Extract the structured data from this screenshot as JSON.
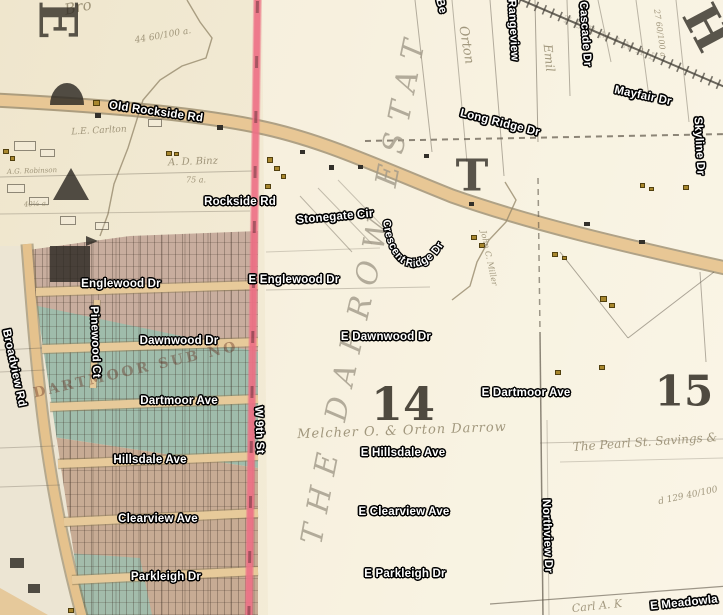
{
  "map": {
    "colors": {
      "parchment": "#f2ead4",
      "parchment_light": "#f7f1e2",
      "road_fill": "#e8c795",
      "road_casing": "#7e6d49",
      "city_boundary_pink": "#ee7186",
      "subdivision_green": "#9fbcab",
      "subdivision_pink": "#c8ad9e",
      "street_label_text": "#ffffff",
      "street_label_halo": "#000000",
      "handwriting_ink": "#8f8468",
      "plat_ink": "#33302a"
    },
    "street_labels": [
      {
        "text": "Old Rockside Rd",
        "x": 156,
        "y": 112,
        "rot": 8
      },
      {
        "text": "Rockside Rd",
        "x": 240,
        "y": 202,
        "rot": 0
      },
      {
        "text": "Stonegate Cir",
        "x": 335,
        "y": 217,
        "rot": -5
      },
      {
        "text": "Long Ridge Dr",
        "x": 500,
        "y": 123,
        "rot": 14
      },
      {
        "text": "Mayfair Dr",
        "x": 643,
        "y": 96,
        "rot": 12
      },
      {
        "text": "Skyline Dr",
        "x": 699,
        "y": 146,
        "rot": 87
      },
      {
        "text": "Rangeview",
        "x": 513,
        "y": 30,
        "rot": 87
      },
      {
        "text": "Cascade Dr",
        "x": 585,
        "y": 34,
        "rot": 86
      },
      {
        "text": "Be",
        "x": 441,
        "y": 6,
        "rot": 75
      },
      {
        "text": "Englewood Dr",
        "x": 121,
        "y": 284,
        "rot": 0
      },
      {
        "text": "E Englewood Dr",
        "x": 294,
        "y": 280,
        "rot": 0
      },
      {
        "text": "Dawnwood Dr",
        "x": 179,
        "y": 341,
        "rot": 0
      },
      {
        "text": "E Dawnwood Dr",
        "x": 386,
        "y": 337,
        "rot": 0
      },
      {
        "text": "Dartmoor Ave",
        "x": 179,
        "y": 401,
        "rot": 0
      },
      {
        "text": "E Dartmoor Ave",
        "x": 526,
        "y": 393,
        "rot": 0
      },
      {
        "text": "Hillsdale Ave",
        "x": 150,
        "y": 460,
        "rot": 0
      },
      {
        "text": "E Hillsdale Ave",
        "x": 403,
        "y": 453,
        "rot": 0
      },
      {
        "text": "Clearview Ave",
        "x": 158,
        "y": 519,
        "rot": 0
      },
      {
        "text": "E Clearview Ave",
        "x": 404,
        "y": 512,
        "rot": 0
      },
      {
        "text": "Parkleigh Dr",
        "x": 166,
        "y": 577,
        "rot": 0
      },
      {
        "text": "E Parkleigh Dr",
        "x": 405,
        "y": 574,
        "rot": 0
      },
      {
        "text": "W 9th St",
        "x": 259,
        "y": 430,
        "rot": 88
      },
      {
        "text": "Northview Dr",
        "x": 547,
        "y": 536,
        "rot": 88
      },
      {
        "text": "Pinewood Ct",
        "x": 95,
        "y": 342,
        "rot": 88
      },
      {
        "text": "Broadview Rd",
        "x": 14,
        "y": 368,
        "rot": 78
      },
      {
        "text": "E Meadowla",
        "x": 684,
        "y": 603,
        "rot": -6
      }
    ],
    "curved_street_label": {
      "text": "Crescent Ridge Dr"
    },
    "estate_label": {
      "text": "THE DARROW ESTATE"
    },
    "section_numbers": [
      {
        "text": "14",
        "x": 403,
        "y": 404,
        "size": 46
      },
      {
        "text": "15",
        "x": 684,
        "y": 391,
        "size": 42
      }
    ],
    "plat_letters": [
      {
        "text": "E",
        "x": 57,
        "y": 20,
        "rot": 90,
        "size": 52
      },
      {
        "text": "T",
        "x": 472,
        "y": 176,
        "rot": 0,
        "size": 44
      },
      {
        "text": "H",
        "x": 706,
        "y": 28,
        "rot": 62,
        "size": 48
      }
    ],
    "annotations": [
      {
        "t": "Bro",
        "x": 78,
        "y": 7,
        "rot": -12,
        "s": 15
      },
      {
        "t": "44 60/100 a.",
        "x": 163,
        "y": 36,
        "rot": -10,
        "s": 9
      },
      {
        "t": "L.E. Carlton",
        "x": 99,
        "y": 131,
        "rot": -3,
        "s": 9
      },
      {
        "t": "A. D. Binz",
        "x": 193,
        "y": 162,
        "rot": -2,
        "s": 10
      },
      {
        "t": "75 a.",
        "x": 196,
        "y": 180,
        "rot": 0,
        "s": 8
      },
      {
        "t": "A.G. Robinson",
        "x": 32,
        "y": 171,
        "rot": -2,
        "s": 7
      },
      {
        "t": "40½ a.",
        "x": 36,
        "y": 204,
        "rot": -3,
        "s": 7
      },
      {
        "t": "Orton",
        "x": 466,
        "y": 45,
        "rot": 80,
        "s": 13
      },
      {
        "t": "Emil",
        "x": 549,
        "y": 58,
        "rot": 84,
        "s": 12
      },
      {
        "t": "John C. Miller",
        "x": 489,
        "y": 258,
        "rot": 78,
        "s": 8
      },
      {
        "t": "Melcher O. & Orton Darrow",
        "x": 402,
        "y": 431,
        "rot": -2,
        "s": 13,
        "ls": 1
      },
      {
        "t": "The Pearl St. Savings &",
        "x": 645,
        "y": 442,
        "rot": -4,
        "s": 12
      },
      {
        "t": "d 129 40/100",
        "x": 688,
        "y": 496,
        "rot": -12,
        "s": 9
      },
      {
        "t": "Carl A. K",
        "x": 597,
        "y": 606,
        "rot": -6,
        "s": 11
      },
      {
        "t": "27 60/100 a",
        "x": 660,
        "y": 33,
        "rot": 82,
        "s": 8
      },
      {
        "t": "TERMINAL",
        "x": 612,
        "y": 40,
        "rot": 23,
        "s": 10,
        "ls": 6,
        "c": "rgba(95,85,70,0.38)"
      },
      {
        "t": "DARTMOOR SUB NO",
        "x": 136,
        "y": 370,
        "rot": -13,
        "s": 14,
        "ls": 3,
        "c": "rgba(99,45,30,0.5)",
        "plain": true
      }
    ],
    "buildings": {
      "gold": [
        [
          93,
          100,
          7,
          6
        ],
        [
          3,
          149,
          6,
          5
        ],
        [
          10,
          156,
          5,
          5
        ],
        [
          166,
          151,
          6,
          5
        ],
        [
          174,
          152,
          5,
          4
        ],
        [
          267,
          157,
          6,
          6
        ],
        [
          274,
          166,
          6,
          5
        ],
        [
          281,
          174,
          5,
          5
        ],
        [
          265,
          184,
          6,
          5
        ],
        [
          471,
          235,
          6,
          5
        ],
        [
          479,
          243,
          6,
          5
        ],
        [
          552,
          252,
          6,
          5
        ],
        [
          562,
          256,
          5,
          4
        ],
        [
          600,
          296,
          7,
          6
        ],
        [
          609,
          303,
          6,
          5
        ],
        [
          640,
          183,
          5,
          5
        ],
        [
          649,
          187,
          5,
          4
        ],
        [
          683,
          185,
          6,
          5
        ],
        [
          555,
          370,
          6,
          5
        ],
        [
          599,
          365,
          6,
          5
        ],
        [
          68,
          608,
          6,
          5
        ]
      ],
      "dark": [
        [
          95,
          113,
          6,
          5
        ],
        [
          217,
          125,
          6,
          5
        ],
        [
          329,
          165,
          5,
          5
        ],
        [
          469,
          202,
          5,
          4
        ],
        [
          584,
          222,
          6,
          4
        ],
        [
          639,
          240,
          6,
          4
        ],
        [
          424,
          154,
          5,
          4
        ],
        [
          300,
          150,
          5,
          4
        ],
        [
          358,
          165,
          5,
          4
        ]
      ],
      "outline": [
        [
          14,
          141,
          22,
          10
        ],
        [
          40,
          149,
          15,
          8
        ],
        [
          7,
          184,
          18,
          9
        ],
        [
          29,
          197,
          20,
          8
        ],
        [
          148,
          119,
          14,
          8
        ],
        [
          60,
          216,
          16,
          9
        ],
        [
          95,
          222,
          14,
          8
        ]
      ]
    },
    "dark_features": [
      {
        "type": "arch",
        "x": 50,
        "y": 83,
        "w": 34,
        "h": 22
      },
      {
        "type": "triangle",
        "x": 53,
        "y": 168,
        "w": 36,
        "h": 32
      },
      {
        "type": "block",
        "x": 50,
        "y": 246,
        "w": 40,
        "h": 36
      },
      {
        "type": "flag",
        "x": 86,
        "y": 236,
        "w": 12,
        "h": 10
      },
      {
        "type": "block",
        "x": 10,
        "y": 558,
        "w": 14,
        "h": 10
      },
      {
        "type": "block",
        "x": 28,
        "y": 584,
        "w": 12,
        "h": 9
      }
    ],
    "local_streets": [
      {
        "x1": 36,
        "y1": 292,
        "x2": 258,
        "y2": 285
      },
      {
        "x1": 42,
        "y1": 349,
        "x2": 258,
        "y2": 342
      },
      {
        "x1": 50,
        "y1": 407,
        "x2": 258,
        "y2": 399
      },
      {
        "x1": 58,
        "y1": 464,
        "x2": 258,
        "y2": 456
      },
      {
        "x1": 64,
        "y1": 522,
        "x2": 258,
        "y2": 513
      },
      {
        "x1": 72,
        "y1": 580,
        "x2": 258,
        "y2": 571
      },
      {
        "x1": 97,
        "y1": 300,
        "x2": 93,
        "y2": 388,
        "narrow": true
      }
    ],
    "parcel_lines": [
      [
        365,
        141,
        728,
        134,
        2,
        0.7,
        1
      ],
      [
        535,
        0,
        538,
        142,
        1,
        0.5,
        0
      ],
      [
        567,
        0,
        570,
        96,
        1,
        0.45,
        0
      ],
      [
        415,
        0,
        432,
        152,
        1,
        0.45,
        0
      ],
      [
        452,
        0,
        467,
        162,
        1,
        0.4,
        0
      ],
      [
        490,
        0,
        504,
        176,
        1,
        0.45,
        0
      ],
      [
        598,
        0,
        611,
        62,
        1,
        0.4,
        0
      ],
      [
        636,
        0,
        649,
        97,
        1,
        0.4,
        0
      ],
      [
        676,
        0,
        689,
        122,
        1,
        0.4,
        0
      ],
      [
        538,
        178,
        540,
        332,
        1.5,
        0.6,
        1
      ],
      [
        540,
        332,
        543,
        618,
        1.5,
        0.7,
        0
      ],
      [
        547,
        420,
        549,
        615,
        1,
        0.3,
        0
      ],
      [
        0,
        177,
        252,
        171,
        1,
        0.35,
        0
      ],
      [
        0,
        214,
        250,
        211,
        1,
        0.3,
        0
      ],
      [
        560,
        252,
        628,
        338,
        1,
        0.5,
        0
      ],
      [
        628,
        338,
        714,
        272,
        1,
        0.5,
        0
      ],
      [
        700,
        272,
        706,
        362,
        1,
        0.45,
        0
      ],
      [
        540,
        443,
        723,
        439,
        1,
        0.3,
        0
      ],
      [
        560,
        462,
        723,
        458,
        1,
        0.25,
        0
      ],
      [
        490,
        604,
        728,
        586,
        1.2,
        0.6,
        0
      ],
      [
        300,
        196,
        352,
        252,
        1,
        0.4,
        0
      ],
      [
        318,
        188,
        372,
        244,
        1,
        0.35,
        0
      ],
      [
        338,
        180,
        392,
        236,
        1,
        0.3,
        0
      ],
      [
        0,
        350,
        42,
        348,
        1,
        0.35,
        0
      ],
      [
        0,
        372,
        45,
        370,
        1,
        0.3,
        0
      ],
      [
        0,
        448,
        55,
        446,
        1,
        0.3,
        0
      ],
      [
        0,
        487,
        60,
        485,
        1,
        0.3,
        0
      ],
      [
        266,
        290,
        430,
        287,
        1,
        0.3,
        0
      ],
      [
        266,
        252,
        380,
        248,
        1,
        0.25,
        0
      ]
    ],
    "creeks": [
      "187,0 200,22 212,38 206,58 182,66 160,80 143,100 128,148 114,184 108,214 100,236",
      "505,182 516,200 506,222 489,240 477,262 470,286 452,300"
    ]
  }
}
